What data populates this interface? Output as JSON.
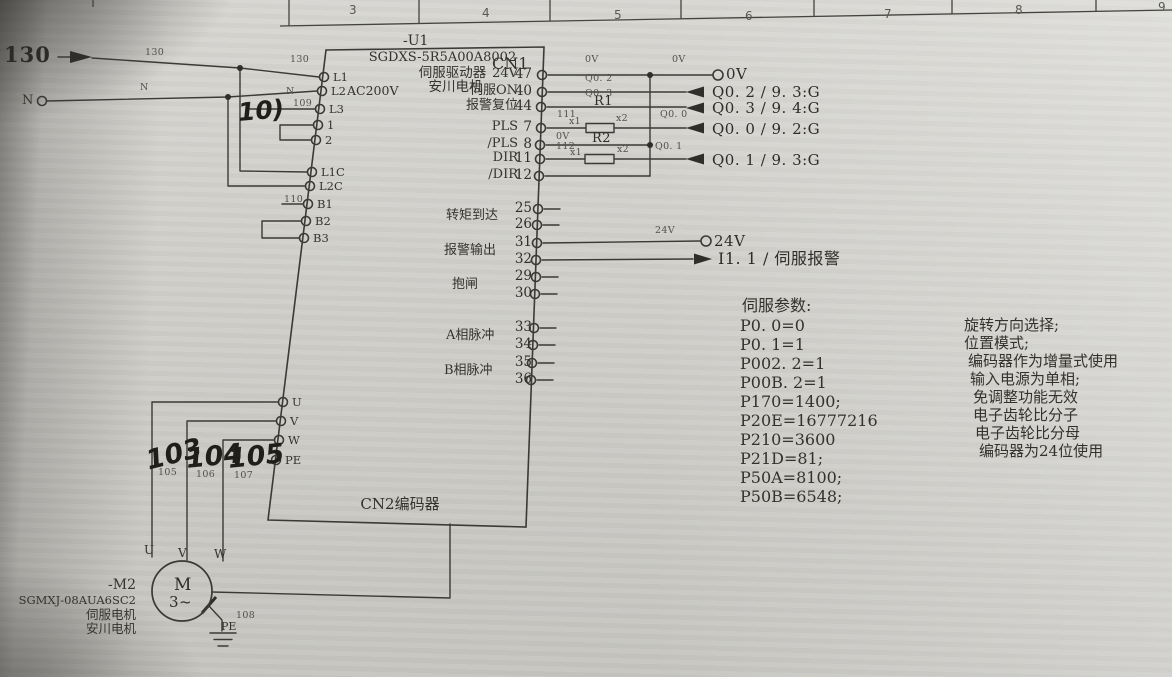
{
  "colors": {
    "paper": "#d3d2cd",
    "ink": "#3b3a36",
    "handwriting": "#201e19"
  },
  "ruler": {
    "cells": [
      "3",
      "4",
      "5",
      "6",
      "7",
      "8",
      "9"
    ]
  },
  "feed": {
    "line_label": "130",
    "line_wire_label_1": "130",
    "line_wire_label_2": "130",
    "neutral_label": "N",
    "neutral_wire_label_1": "N",
    "neutral_wire_label_2": "N",
    "l3_wire_label": "109",
    "l3_handwritten": "10)",
    "b1_wire_label": "110"
  },
  "drive": {
    "ref": "-U1",
    "model": "SGDXS-5R5A00A8002",
    "title": "伺服驱动器",
    "brand": "安川电机",
    "supply": "AC200V",
    "cn1_label": "CN1",
    "cn2_label": "CN2编码器",
    "left_pins": [
      "L1",
      "L2",
      "L3",
      "1",
      "2",
      "L1C",
      "L2C",
      "B1",
      "B2",
      "B3"
    ],
    "motor_pins": [
      "U",
      "V",
      "W",
      "PE"
    ],
    "cn1_signals": [
      {
        "label": "24V",
        "pin": "47"
      },
      {
        "label": "伺服ON",
        "pin": "40"
      },
      {
        "label": "报警复位",
        "pin": "44"
      },
      {
        "label": "PLS",
        "pin": "7"
      },
      {
        "label": "/PLS",
        "pin": "8"
      },
      {
        "label": "DIR",
        "pin": "11"
      },
      {
        "label": "/DIR",
        "pin": "12"
      }
    ],
    "cn1_groups": [
      {
        "label": "转矩到达",
        "pin_a": "25",
        "pin_b": "26"
      },
      {
        "label": "报警输出",
        "pin_a": "31",
        "pin_b": "32"
      },
      {
        "label": "抱闸",
        "pin_a": "29",
        "pin_b": "30"
      },
      {
        "label": "A相脉冲",
        "pin_a": "33",
        "pin_b": "34"
      },
      {
        "label": "B相脉冲",
        "pin_a": "35",
        "pin_b": "36"
      }
    ]
  },
  "outputs": {
    "v0_terminal": "0V",
    "v0_wire_1": "0V",
    "v0_wire_2": "0V",
    "v0_wire_3": "0V",
    "q02_wire": "Q0. 2",
    "q02": "Q0. 2 / 9. 3:G",
    "q03_wire": "Q0. 3",
    "q03": "Q0. 3 / 9. 4:G",
    "q00_wire": "Q0. 0",
    "q00": "Q0. 0 / 9. 2:G",
    "q01_wire": "Q0. 1",
    "q01": "Q0. 1 / 9. 3:G",
    "r1": "R1",
    "r2": "R2",
    "w111": "111",
    "w112": "112",
    "x1_a": "x1",
    "x2_a": "x2",
    "x1_b": "x1",
    "x2_b": "x2",
    "v24_wire": "24V",
    "v24_terminal": "24V",
    "alarm_input": "I1. 1 / 伺服报警"
  },
  "params": {
    "title": "伺服参数:",
    "items": [
      "P0. 0=0",
      "P0. 1=1",
      "P002. 2=1",
      "P00B. 2=1",
      "P170=1400;",
      "P20E=16777216",
      "P210=3600",
      "P21D=81;",
      "P50A=8100;",
      "P50B=6548;"
    ]
  },
  "notes": {
    "items": [
      "旋转方向选择;",
      "位置模式;",
      "编码器作为增量式使用",
      "输入电源为单相;",
      "免调整功能无效",
      "电子齿轮比分子",
      "电子齿轮比分母",
      "编码器为24位使用"
    ]
  },
  "motor": {
    "ref": "-M2",
    "model": "SGMXJ-08AUA6SC2",
    "type": "伺服电机",
    "brand": "安川电机",
    "symbol": "M",
    "phases": "3~",
    "u": "U",
    "v": "V",
    "w": "W",
    "pe": "PE",
    "u_handwritten": "103",
    "v_handwritten": "104",
    "w_handwritten": "105",
    "u_wire_label": "105",
    "v_wire_label": "106",
    "w_wire_label": "107",
    "pe_wire_label": "108"
  }
}
